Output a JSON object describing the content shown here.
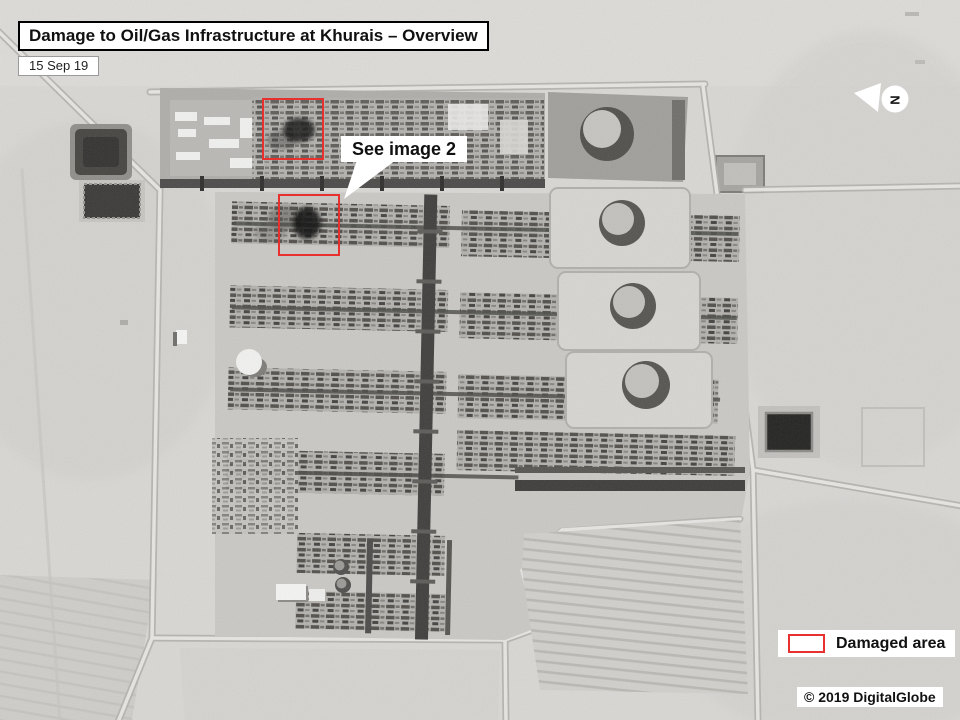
{
  "header": {
    "title": "Damage to Oil/Gas Infrastructure at Khurais – Overview",
    "date": "15 Sep 19"
  },
  "annotations": {
    "callout_label": "See image 2",
    "north_label": "N",
    "damage_color": "#e8312e",
    "damage_boxes": [
      {
        "name": "damaged-area-north",
        "x": 262,
        "y": 98,
        "w": 62,
        "h": 62
      },
      {
        "name": "damaged-area-south",
        "x": 278,
        "y": 194,
        "w": 62,
        "h": 62
      }
    ]
  },
  "legend": {
    "label": "Damaged area",
    "swatch_color": "#e8312e"
  },
  "credit": {
    "text": "© 2019 DigitalGlobe"
  }
}
